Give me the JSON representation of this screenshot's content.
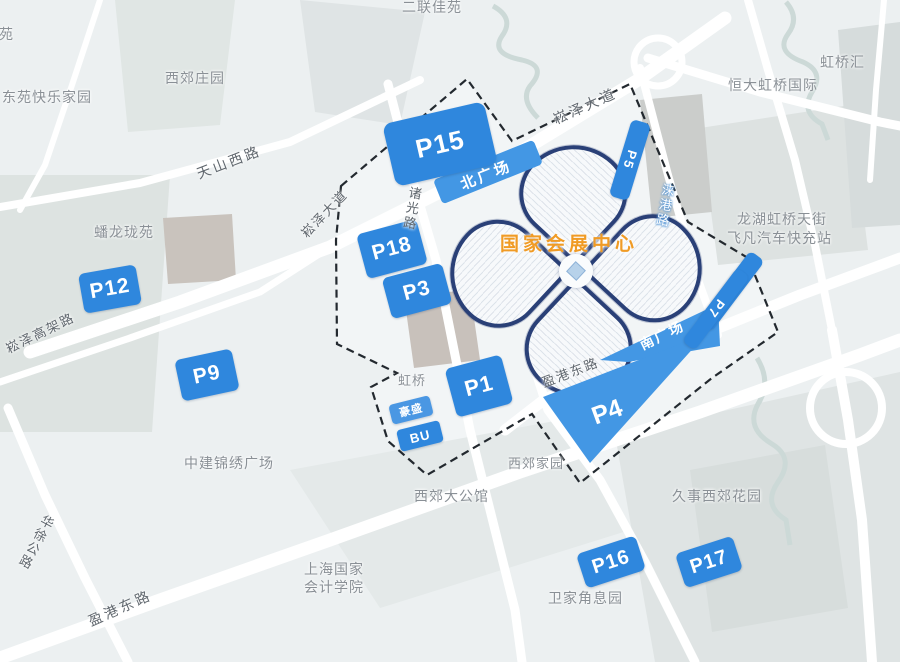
{
  "venue": {
    "name": "国家会展中心"
  },
  "labels": {
    "p15": "P15",
    "p5": "P5",
    "p18": "P18",
    "p3": "P3",
    "p12": "P12",
    "p9": "P9",
    "p1": "P1",
    "p8": "P8",
    "p7": "P7",
    "p4": "P4",
    "p16": "P16",
    "p17": "P17",
    "haosheng": "豪盛",
    "bu": "BU",
    "north_plaza": "北广场",
    "south_plaza": "南广场"
  },
  "roads": {
    "songze_avenue": "崧泽大道",
    "songze_viaduct": "崧泽高架路",
    "tianshan_west": "天山西路",
    "zhuguang": "诸光路",
    "laigang": "涞港路",
    "yingang_east": "盈港东路",
    "huaxu_highway": "华徐公路"
  },
  "places": {
    "yayuan": "雅苑",
    "dongyuan_happy_home": "东苑快乐家园",
    "xijiao_manor": "西郊庄园",
    "erlian_jiayuan": "二联佳苑",
    "hongqiao_hui": "虹桥汇",
    "hengda_hongqiao": "恒大虹桥国际",
    "longfor_tianjie": "龙湖虹桥天街",
    "feifan_charging": "飞凡汽车快充站",
    "panlong_longyuan": "蟠龙珑苑",
    "hongqiao_partial": "虹桥",
    "zhongjian_plaza": "中建锦绣广场",
    "xijiao_jiayuan": "西郊家园",
    "xijiao_mansion": "西郊大公馆",
    "jiushi_garden": "久事西郊花园",
    "accounting_institute": "上海国家会计学院",
    "weijiajiao": "卫家角息园"
  },
  "colors": {
    "blue": "#2f87dd",
    "zoneblue": "#4397e4",
    "navy": "#2a4077",
    "orange": "#f09b25"
  }
}
